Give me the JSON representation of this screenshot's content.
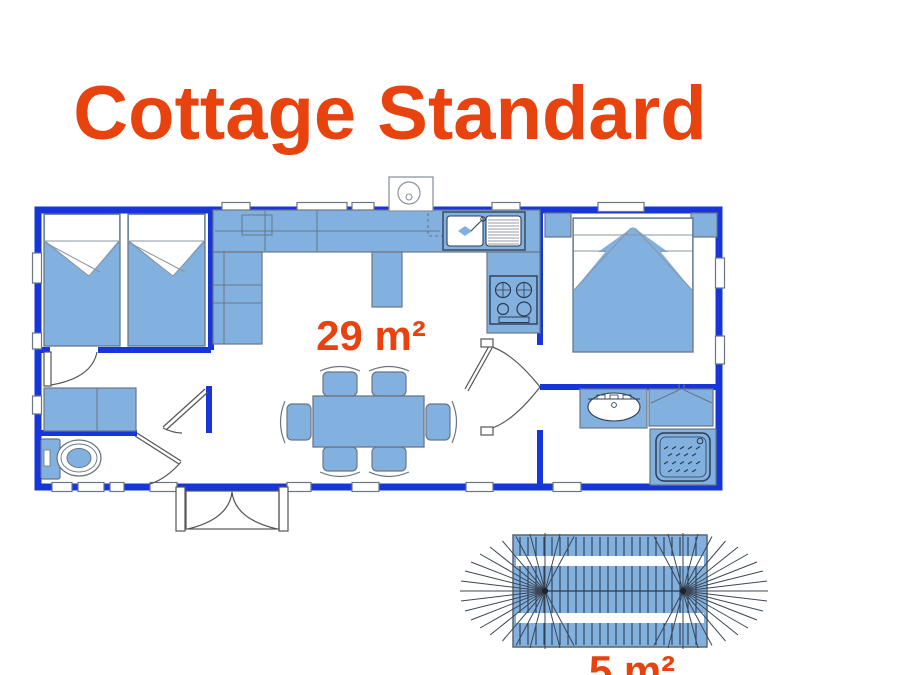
{
  "title": "Cottage Standard",
  "labels": {
    "interior_area": "29 m²",
    "terrace_area": "5 m²"
  },
  "colors": {
    "title_text": "#E8430F",
    "area_label_text": "#E8430F",
    "wall": "#1636D9",
    "furniture_fill": "#82B1DF",
    "furniture_outline": "#6A7684",
    "detail_line": "#2E3C50",
    "door_arc": "#555555",
    "background": "#FFFFFF"
  },
  "icons": [
    "twin-bed-icon",
    "double-bed-icon",
    "nightstand-icon",
    "kitchen-counter-icon",
    "sink-icon",
    "stove-icon",
    "water-heater-icon",
    "dining-table-icon",
    "chair-icon",
    "wardrobe-icon",
    "toilet-icon",
    "washbasin-icon",
    "shower-icon",
    "window-icon",
    "door-arc-icon",
    "entrance-double-door-icon",
    "terrace-awning-icon"
  ]
}
